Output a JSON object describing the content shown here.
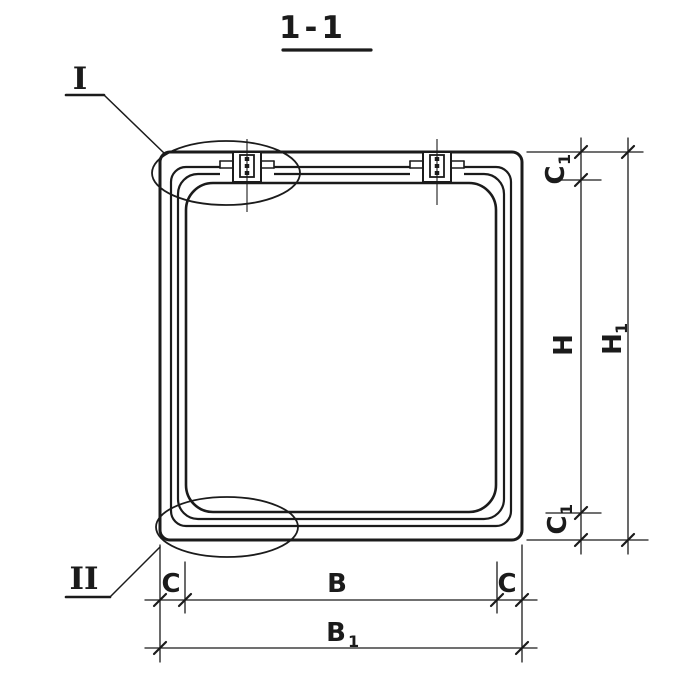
{
  "title": "1-1",
  "callouts": {
    "detail_one": "I",
    "detail_two": "II"
  },
  "dims": {
    "c1_top": {
      "base": "C",
      "sub": "1"
    },
    "h": {
      "base": "H"
    },
    "h1": {
      "base": "H",
      "sub": "1"
    },
    "c1_bottom": {
      "base": "C",
      "sub": "1"
    },
    "c_left": {
      "base": "C"
    },
    "b": {
      "base": "B"
    },
    "c_right": {
      "base": "C"
    },
    "b1": {
      "base": "B",
      "sub": "1"
    }
  },
  "colors": {
    "ink": "#1b1b1b",
    "paper": "#ffffff"
  }
}
